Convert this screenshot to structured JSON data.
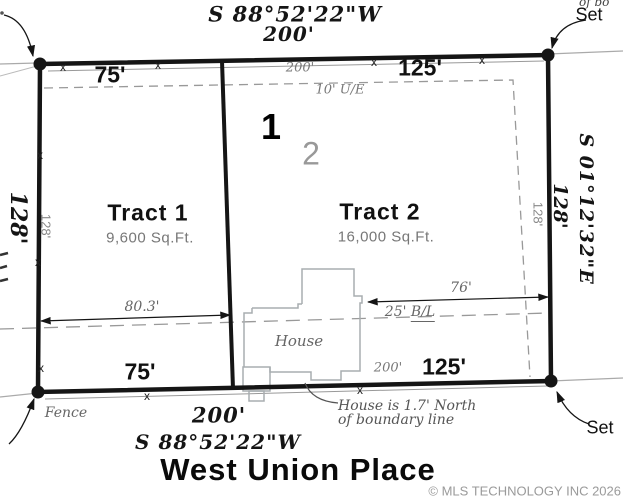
{
  "colors": {
    "ink": "#151515",
    "gray_text": "#666666",
    "line_gray": "#9a9a9a",
    "house_gray": "#a8adb0"
  },
  "north": {
    "bearing": "S 88°52'22\"W",
    "distance": "200'",
    "tract1_width": "75'",
    "overall": "200'",
    "tract2_width": "125'",
    "easement": "10' U/E"
  },
  "south": {
    "bearing": "S 88°52'22\"W",
    "distance": "200'",
    "tract1_width": "75'",
    "overall": "200'",
    "tract2_width": "125'",
    "fence": "Fence",
    "note_line1": "House is 1.7' North",
    "note_line2": "of boundary line"
  },
  "west": {
    "depth": "128'",
    "inner_depth": "128'"
  },
  "east": {
    "bearing": "S 01°12'32\"E",
    "depth": "128'",
    "inner_depth": "128'"
  },
  "tracts": [
    {
      "lot": "1",
      "name": "Tract 1",
      "area": "9,600 Sq.Ft."
    },
    {
      "lot": "2",
      "name": "Tract 2",
      "area": "16,000 Sq.Ft."
    }
  ],
  "interior": {
    "dim_left": "80.3'",
    "dim_right": "76'",
    "bl_prefix": "25'",
    "bl_suffix": "B/L",
    "house": "House"
  },
  "markers": {
    "set": "Set",
    "fence_x": "x",
    "clipped_top_right": "of bo"
  },
  "street": {
    "name": "West Union Place"
  },
  "footer": {
    "copyright": "© MLS TECHNOLOGY INC 2026"
  }
}
